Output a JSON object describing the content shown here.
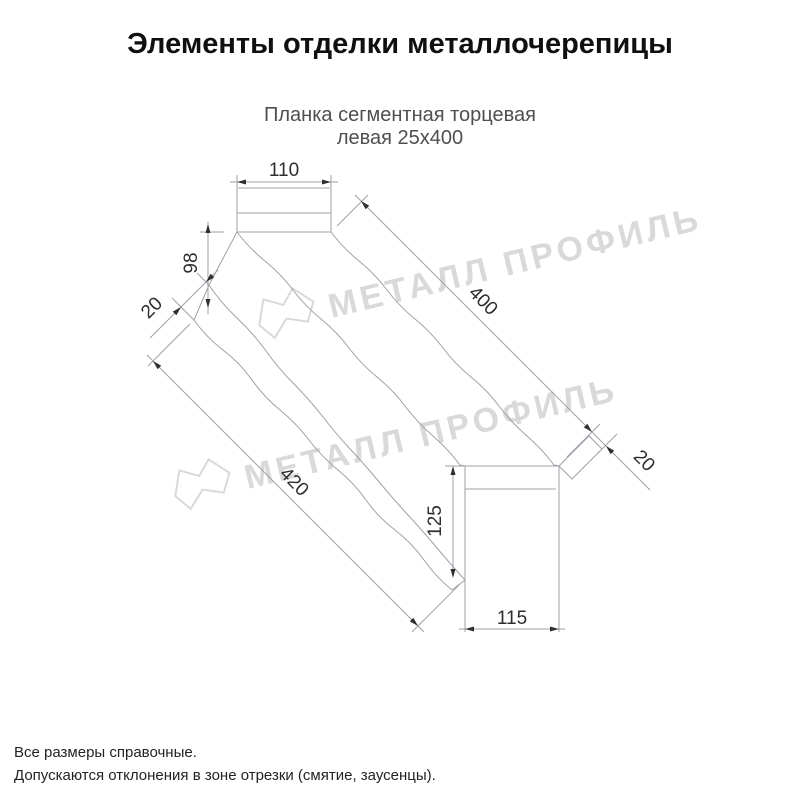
{
  "title": "Элементы отделки металлочерепицы",
  "product": {
    "line1": "Планка сегментная торцевая",
    "line2": "левая 25х400"
  },
  "watermark": {
    "brand": "МЕТАЛЛ ПРОФИЛЬ"
  },
  "dimensions": {
    "top_flange_width": "110",
    "end_drop_height": "98",
    "near_hem": "20",
    "top_edge_length": "400",
    "bottom_edge_length": "420",
    "end_face_height": "125",
    "end_face_width": "115",
    "far_tab": "20"
  },
  "footer": {
    "line1": "Все размеры справочные.",
    "line2": "Допускаются отклонения в зоне отрезки (смятие, заусенцы)."
  },
  "colors": {
    "line": "#a0a0a8",
    "dim-text": "#2e2e2e",
    "arrow": "#2f2f2f",
    "watermark": "#d9d9d9",
    "title": "#101010",
    "subtitle": "#4f4f4f",
    "footer": "#232323",
    "bg": "#ffffff"
  }
}
